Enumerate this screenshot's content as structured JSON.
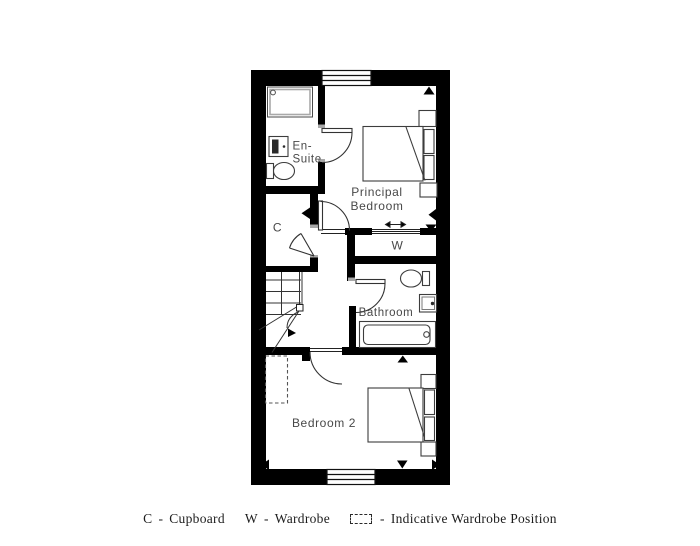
{
  "plan": {
    "labels": {
      "en_suite_line1": "En-",
      "en_suite_line2": "Suite",
      "principal_line1": "Principal",
      "principal_line2": "Bedroom",
      "cupboard": "C",
      "wardrobe": "W",
      "bathroom": "Bathroom",
      "bedroom2": "Bedroom 2"
    },
    "colors": {
      "wall": "#000000",
      "furniture_line": "#3d3d3d",
      "label_text": "#484848"
    }
  },
  "legend": {
    "dash": "-",
    "cupboard_symbol": "C",
    "cupboard_label": "Cupboard",
    "wardrobe_symbol": "W",
    "wardrobe_label": "Wardrobe",
    "wardrobe_position_label": "Indicative Wardrobe Position"
  }
}
